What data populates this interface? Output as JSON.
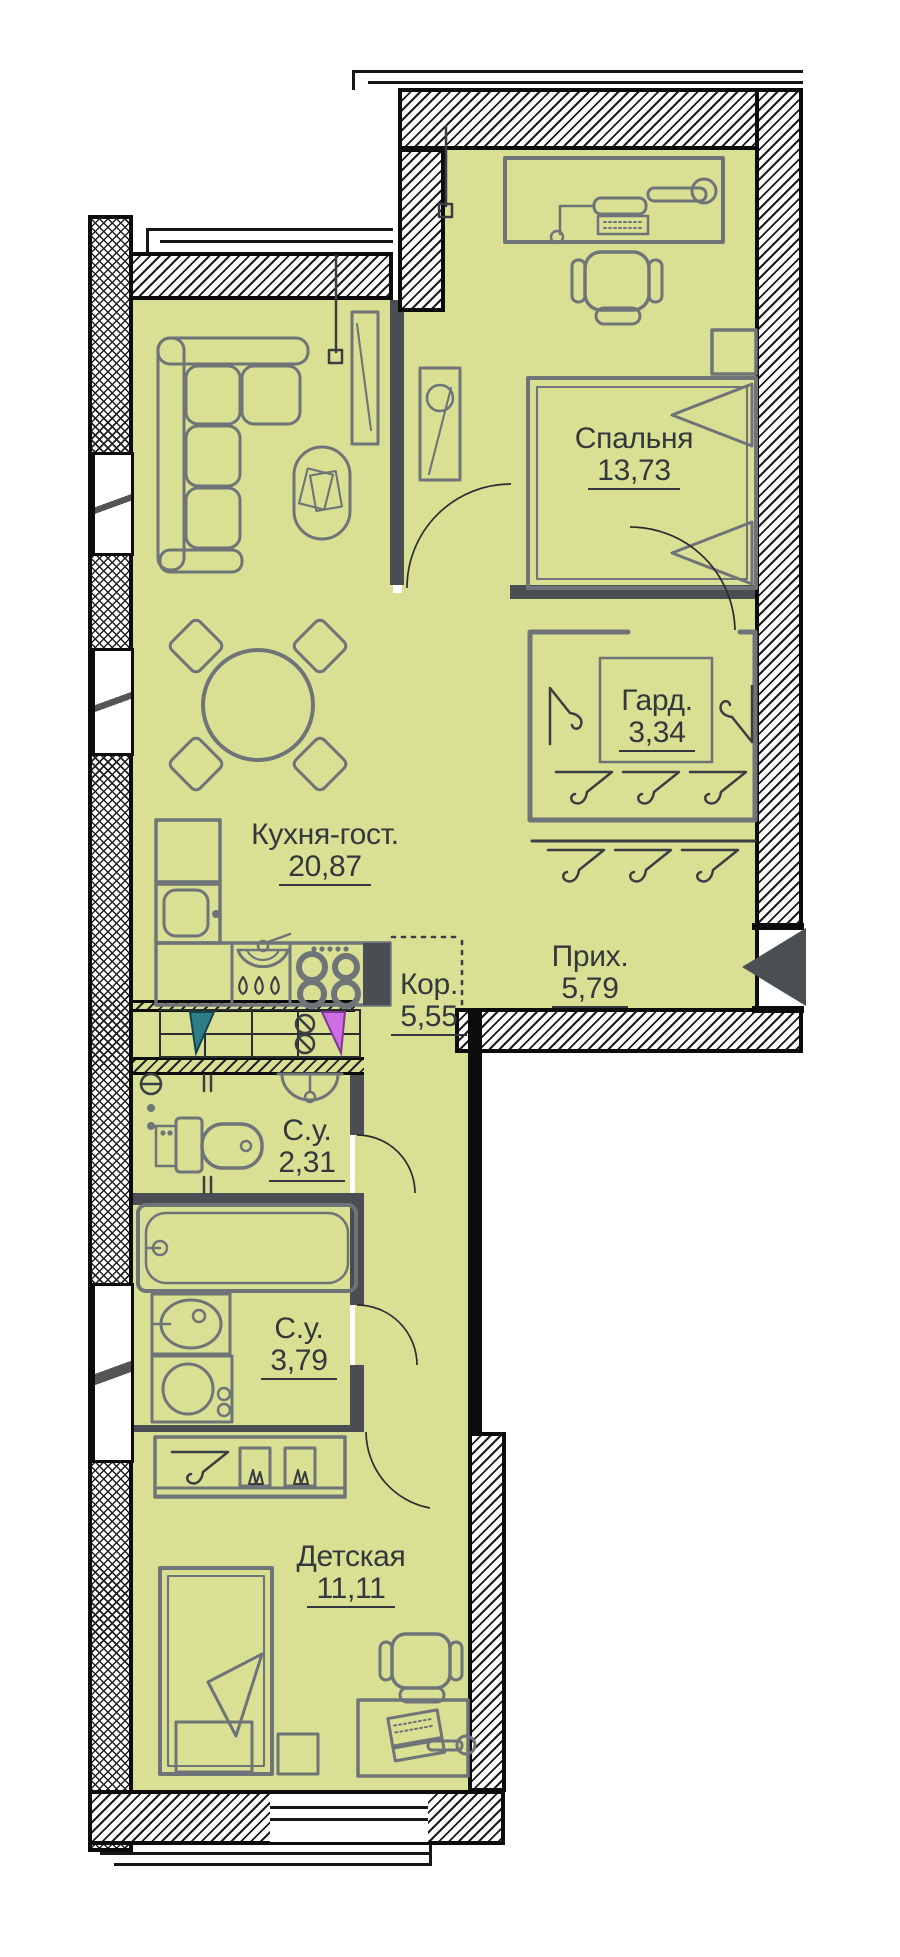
{
  "plan_title": "apartment-floor-plan",
  "colors": {
    "room_fill": "#d9e094",
    "furniture": "#6f7478",
    "wall_dark": "#0c0c0c",
    "partition": "#4a4e52",
    "label_text": "#33383c",
    "riser_cold": "#2e7e8a",
    "riser_hot": "#cf6ee4",
    "entry_arrow": "#4a4f54"
  },
  "rooms": [
    {
      "id": "bedroom",
      "name": "Спальня",
      "area": "13,73"
    },
    {
      "id": "kitchen_living",
      "name": "Кухня-гост.",
      "area": "20,87"
    },
    {
      "id": "wardrobe",
      "name": "Гард.",
      "area": "3,34"
    },
    {
      "id": "hallway",
      "name": "Прих.",
      "area": "5,79"
    },
    {
      "id": "corridor",
      "name": "Кор.",
      "area": "5,55"
    },
    {
      "id": "bathroom_guest",
      "name": "С.у.",
      "area": "2,31"
    },
    {
      "id": "bathroom_main",
      "name": "С.у.",
      "area": "3,79"
    },
    {
      "id": "children",
      "name": "Детская",
      "area": "11,11"
    }
  ]
}
